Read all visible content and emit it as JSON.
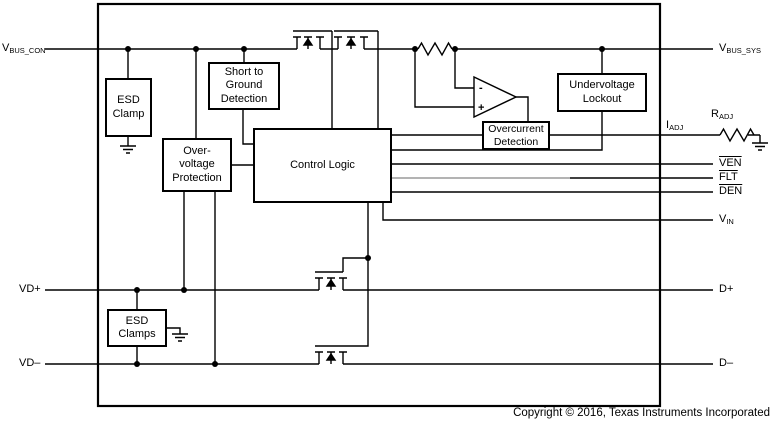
{
  "figure": {
    "blocks": {
      "esd_clamp": "ESD\nClamp",
      "short_to_ground": "Short to\nGround\nDetection",
      "overvoltage": "Over-\nvoltage\nProtection",
      "control_logic": "Control Logic",
      "overcurrent": "Overcurrent\nDetection",
      "undervoltage": "Undervoltage\nLockout",
      "esd_clamps": "ESD\nClamps"
    },
    "pins": {
      "vbus_con": {
        "main": "V",
        "sub": "BUS_CON"
      },
      "vd_plus": "VD+",
      "vd_minus": "VD–",
      "vbus_sys": {
        "main": "V",
        "sub": "BUS_SYS"
      },
      "i_adj": {
        "main": "I",
        "sub": "ADJ"
      },
      "r_adj": {
        "main": "R",
        "sub": "ADJ"
      },
      "ven": "VEN",
      "flt": "FLT",
      "den": "DEN",
      "v_in": {
        "main": "V",
        "sub": "IN"
      },
      "d_plus": "D+",
      "d_minus": "D–"
    },
    "opamp": {
      "minus": "-",
      "plus": "+"
    },
    "copyright": "Copyright © 2016, Texas Instruments Incorporated",
    "colors": {
      "line": "#000000",
      "grey_line": "#9a9a9a",
      "background": "#ffffff"
    }
  }
}
